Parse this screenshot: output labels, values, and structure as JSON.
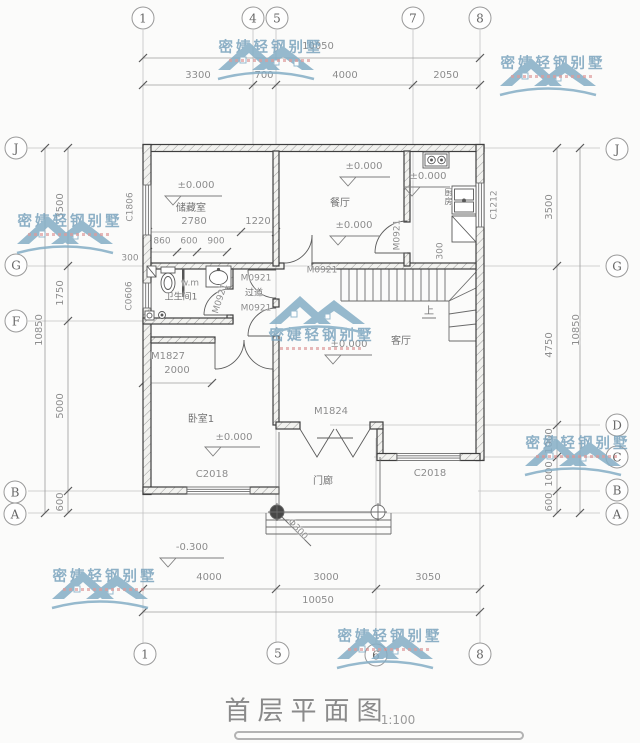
{
  "title": {
    "text": "首层平面图",
    "scale": "1:100"
  },
  "watermark": {
    "brand": "密婕轻钢别墅"
  },
  "axes": {
    "top": [
      "1",
      "4",
      "5",
      "7",
      "8"
    ],
    "bottom": [
      "1",
      "5",
      "6",
      "8"
    ],
    "left": [
      "J",
      "G",
      "F",
      "B",
      "A"
    ],
    "right": [
      "J",
      "G",
      "D",
      "C",
      "B",
      "A"
    ]
  },
  "dims": {
    "top": {
      "total": "10050",
      "segments": [
        "3300",
        "700",
        "4000",
        "2050"
      ]
    },
    "bottom": {
      "total": "10050",
      "segments": [
        "4000",
        "3000",
        "3050"
      ]
    },
    "left": {
      "total": "10850",
      "segments": [
        "3500",
        "1750",
        "5000",
        "600"
      ]
    },
    "right": {
      "total": "10850",
      "segments": [
        "3500",
        "4750",
        "1000",
        "1000",
        "600"
      ]
    },
    "interior": {
      "storage_width": "2780",
      "entry_gap": "1220",
      "bath_segs": [
        "860",
        "600",
        "900"
      ],
      "bedroom_wall": "2000",
      "offset_left": "300",
      "offset_kitchen": "300"
    }
  },
  "rooms": {
    "storage": "储藏室",
    "dining": "餐厅",
    "kitchen": "厨房",
    "bathroom": "卫生间1",
    "corridor": "过道",
    "living": "客厅",
    "bedroom": "卧室1",
    "porch": "门廊"
  },
  "openings": {
    "m0921": "M0921",
    "m1827": "M1827",
    "m1824": "M1824",
    "c1806": "C1806",
    "c0606": "C0606",
    "c1212": "C1212",
    "c2018": "C2018"
  },
  "levels": {
    "zero": "±0.000",
    "outdoor": "-0.300"
  },
  "annotations": {
    "up": "上",
    "column_dia": "Φ300",
    "washer": "w.m"
  }
}
